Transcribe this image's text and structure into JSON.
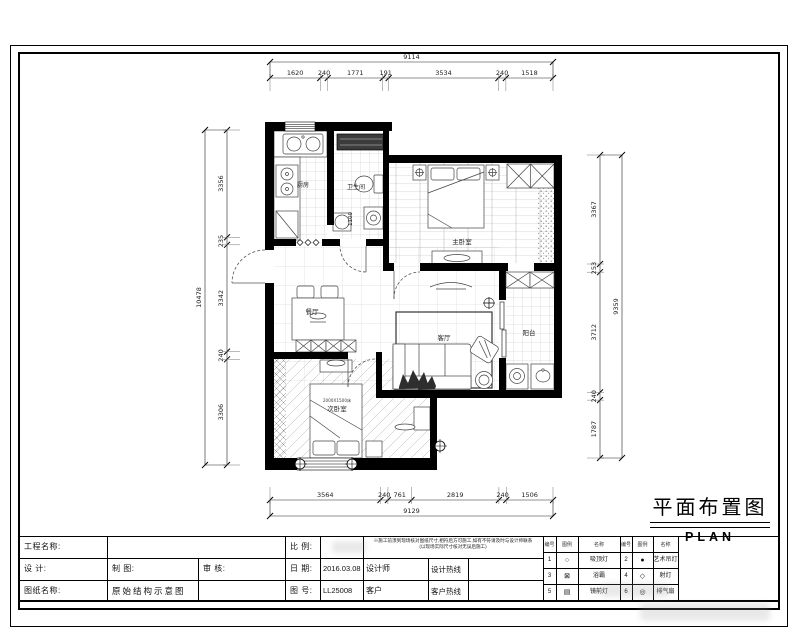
{
  "sheet": {
    "title_cn": "平面布置图",
    "title_en": "PLAN"
  },
  "dimensions": {
    "top": {
      "total": "9114",
      "segments": [
        "1620",
        "240",
        "1771",
        "191",
        "3534",
        "240",
        "1518"
      ]
    },
    "bottom": {
      "total": "9129",
      "segments": [
        "3564",
        "240",
        "761",
        "2819",
        "240",
        "1506"
      ]
    },
    "left": {
      "total": "10478",
      "segments": [
        "3356",
        "235",
        "3342",
        "240",
        "3306"
      ]
    },
    "right": {
      "total": "9359",
      "segments": [
        "3367",
        "253",
        "3712",
        "240",
        "1787"
      ]
    }
  },
  "plan": {
    "rooms": {
      "kitchen": "厨房",
      "bathroom": "卫生间",
      "master_bedroom": "主卧室",
      "dining": "餐厅",
      "living": "客厅",
      "balcony": "阳台",
      "second_bedroom": "次卧室"
    },
    "annotations": {
      "bath_width": "1100",
      "bed_size": "2000X1500床"
    }
  },
  "titleblock": {
    "project_label": "工程名称:",
    "design_label": "设  计:",
    "draft_label": "制  图:",
    "review_label": "审  核:",
    "sheet_label": "图纸名称:",
    "sheet_value": "原始结构示意图",
    "scale_label": "比  例:",
    "scale_value": "",
    "date_label": "日  期:",
    "date_value": "2016.03.08",
    "no_label": "图  号:",
    "no_value": "LL25008",
    "designer_label": "设计师",
    "design_hotline_label": "设计热线",
    "client_label": "客户",
    "client_hotline_label": "客户热线",
    "note_line1": "※施工前须到现场核对图纸尺寸,相符后方可施工,如有不符请及时与设计师联系",
    "note_line2": "(以现场实际尺寸核对无误后施工)"
  },
  "legend": {
    "headers": [
      "编号",
      "图例",
      "名称",
      "编号",
      "图例",
      "名称"
    ],
    "rows": [
      [
        "1",
        "○",
        "吸顶灯",
        "2",
        "●",
        "艺术吊灯"
      ],
      [
        "3",
        "⊠",
        "浴霸",
        "4",
        "◇",
        "射灯"
      ],
      [
        "5",
        "▤",
        "镜前灯",
        "6",
        "◎",
        "排气扇"
      ]
    ]
  }
}
